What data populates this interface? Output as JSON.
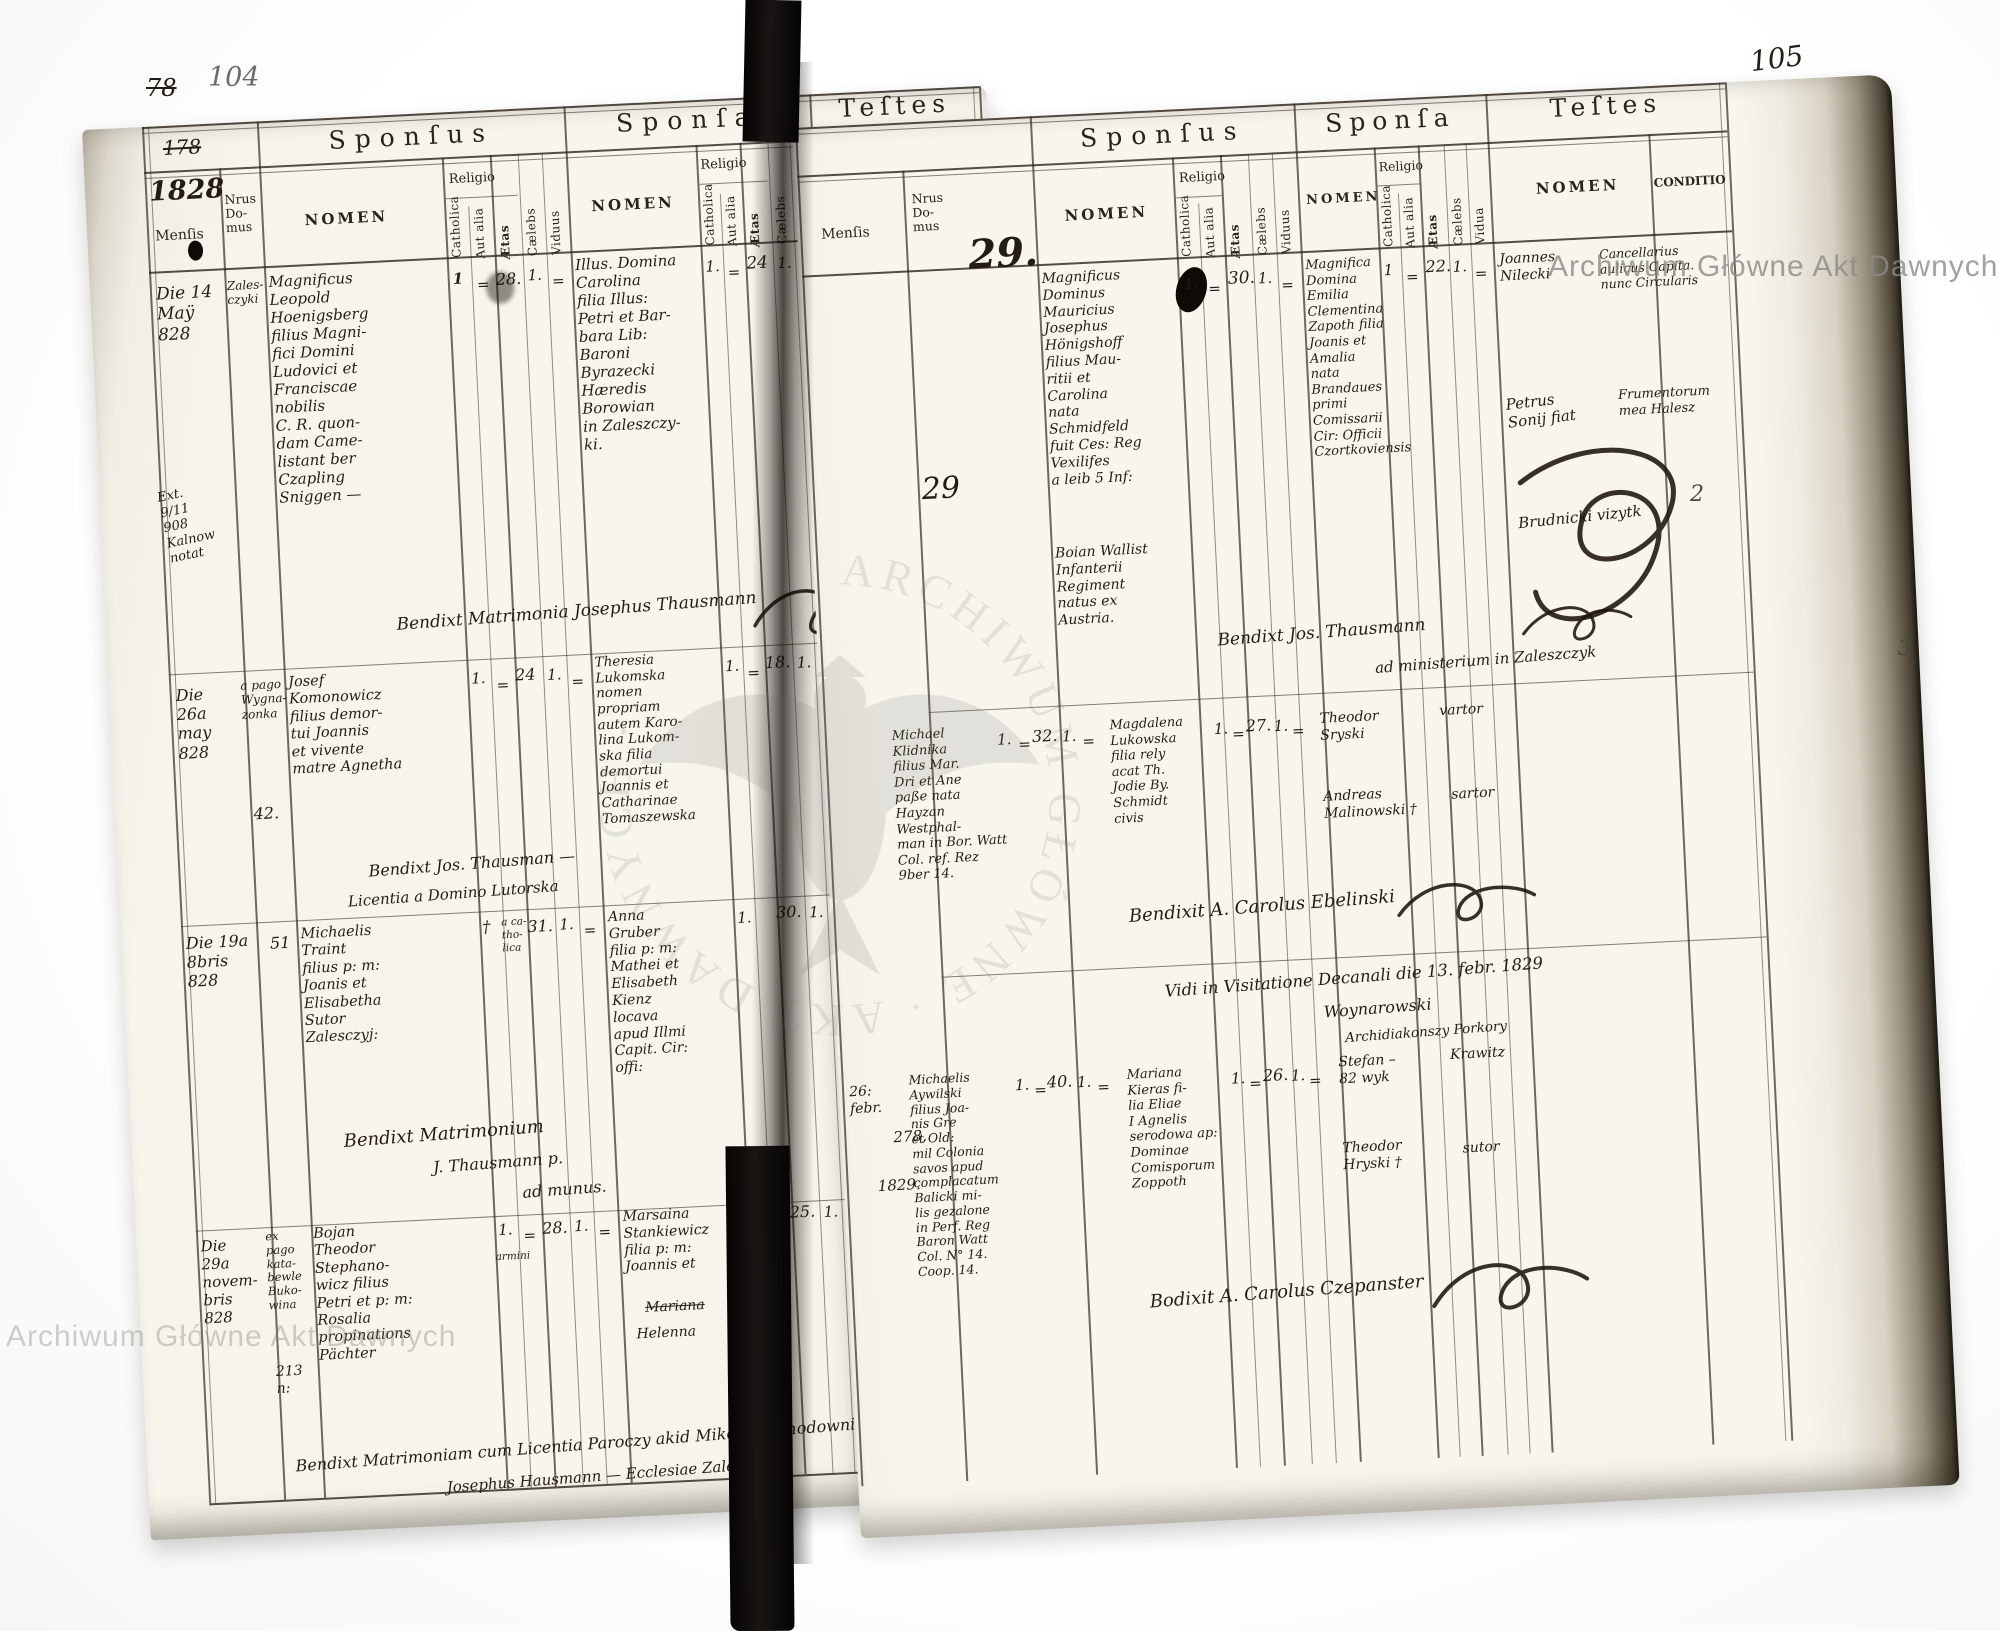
{
  "meta": {
    "left_folio_crossed": "78",
    "left_folio": "104",
    "right_folio": "105",
    "crossed_number": "178",
    "year": "1828",
    "margin_mark_2": "2",
    "margin_mark_3": "3"
  },
  "labels": {
    "sponsus": "Sponſus",
    "sponsa": "Sponſa",
    "testes": "Teſtes",
    "mensis": "Menſis",
    "nrus_domus": "Nrus\nDo-\nmus",
    "nomen": "NOMEN",
    "conditio": "CONDITIO",
    "religio": "Religio",
    "catholica": "Catholica",
    "aut_alia": "Aut alia",
    "aetas": "Ætas",
    "caelebs": "Cælebs",
    "viduus": "Viduus",
    "vidua": "Vidua"
  },
  "watermark": {
    "text": "Archiwum Główne Akt Dawnych",
    "emblem_ring": "ARCHIWUM GŁÓWNE · AKT DAWNYCH ·"
  },
  "l": {
    "r1": {
      "mensis": "Die 14\nMaÿ\n828",
      "margin_note": "Ext.\n9/11\n908\nKalnow\nnotat",
      "domus": "Zales-\nczyki",
      "sp_nomen": "Magnificus\nLeopold\nHoenigsberg\nfilius Magni-\nfici Domini\nLudovici et\nFranciscae\nnobilis\nC. R. quon-\ndam Came-\nlistant ber\nCzapling\nSniggen —",
      "sp_c": "1",
      "sp_a": "=",
      "sp_ae": "28.",
      "sp_cl": "1.",
      "sp_v": "=",
      "sa_nomen": "Illus. Domina\nCarolina\nfilia Illus:\nPetri et Bar-\nbara Lib:\nBaroni\nByrazecki\nHæredis\nBorowian\nin Zaleszczy-\nki.",
      "sa_c": "1.",
      "sa_a": "=",
      "sa_ae": "24",
      "sa_cl": "1.",
      "sa_v": "=",
      "t1": "Joannes Nilecki",
      "t2": "Antoni Orłowski",
      "cond1": "Comiteonis Gu-\nnialis et Capita-\nneus Circularis\nficunti Czortko-\nviensis.",
      "cond2": "Hæres bonor.\nac Nobilis",
      "bene": "Bendixt Matrimonia Josephus Thausmann"
    },
    "r2": {
      "mensis": "Die\n26a\nmay\n828",
      "domus1": "a pago\nWygna-\nzonka",
      "domus2": "42.",
      "sp_nomen": "Josef\nKomonowicz\nfilius demor-\ntui Joannis\net vivente\nmatre Agnetha",
      "sp_c": "1.",
      "sp_a": "=",
      "sp_ae": "24",
      "sp_cl": "1.",
      "sp_v": "=",
      "sa_nomen": "Theresia\nLukomska\nnomen\npropriam\nautem Karo-\nlina Lukom-\nska filia\ndemortui\nJoannis et\nCatharinae\nTomaszewska",
      "sa_c": "1.",
      "sa_a": "=",
      "sa_ae": "18.",
      "sa_cl": "1.",
      "sa_v": "=",
      "t1": "Matheusz\nJuzefowicz †",
      "t2": "Stanisław\nLakomski",
      "cond1": "Nobelis",
      "cond2": "Mastelarz",
      "bene1": "Bendixt Jos. Thausman —",
      "bene2": "Licentia a Domino Lutorska"
    },
    "r3": {
      "mensis": "Die 19a\n8bris\n828",
      "domus": "51",
      "sp_nomen": "Michaelis\nTraint\nfilius p: m:\nJoanis et\nElisabetha\nSutor\nZalesczyj:",
      "sp_c": "†",
      "sp_rel": "a ca-\ntho-\nlica",
      "sp_ae": "31.",
      "sp_cl": "1.",
      "sp_v": "=",
      "sa_nomen": "Anna\nGruber\nfilia p: m:\nMathei et\nElisabeth\nKienz\nlocava\napud Illmi\nCapit. Cir:\noffi:",
      "sa_c": "1.",
      "sa_a": "=",
      "sa_ae": "30.",
      "sa_cl": "1.",
      "sa_v": "=",
      "t1": "Georgius\nKhirzew-\nski †",
      "t2": "Antonius\nRaucz",
      "t3": "Joanes\nKhyntzel",
      "cond1": "Sartor\nZalesz:",
      "cond2": "Laut.\ngwann",
      "cond3": "Civis\nZalesz:",
      "bene1": "Bendixt Matrimonium",
      "bene2": "J. Thausmann p.",
      "bene3": "ad munus."
    },
    "r4": {
      "mensis": "Die\n29a\nnovem-\nbris\n828",
      "domus1": "ex\npago\nkata-\nbewle\nBuko-\nwina",
      "domus2": "213\nn:",
      "sp_nomen": "Bojan\nTheodor\nStephano-\nwicz filius\nPetri et p: m:\nRosalia\npropinations\nPächter",
      "sp_c": "1.",
      "sp_a": "=",
      "sp_rel": "armini",
      "sp_ae": "28.",
      "sp_cl": "1.",
      "sp_v": "=",
      "sa_nomen": "Marsaina\nStankiewicz\nfilia p: m:\nJoannis et",
      "sa_struck": "Mariana",
      "sa_nomen2": "Helenna",
      "sa_c": "1.",
      "sa_a": "=",
      "sa_rel": "armini",
      "sa_ae": "25.",
      "sa_cl": "1.",
      "sa_v": "=",
      "t1": "Antoni\nLenkiewicz",
      "t2": "Teodor\nHatun",
      "t3": "Jakub\nLukiewicz",
      "cond1": "Preczmistrz",
      "cond2": "Jurgher",
      "cond3": "Mechtik\nGutthaber",
      "cond4": "D. r. A:\nin Snestyn",
      "bene1": "Bendixt Matrimoniam cum Licentia Paroczy akid Mikolai Zlahodowni",
      "bene2": "Josephus Hausmann — Ecclesiae Zalesz. n. k."
    }
  },
  "r": {
    "mark29a": "29.",
    "mark29b": "29",
    "r1": {
      "sp_nomen": "Magnificus\nDominus\nMauricius\nJosephus\nHönigshoff\nfilius Mau-\nritii et\nCarolina\nnata\nSchmidfeld\nfuit Ces: Reg\nVexilifes\na leib 5 Inf:",
      "sp_nomen2": "Boian Wallist\nInfanterii\nRegiment\nnatus ex\nAustria.",
      "sp_c": "1.",
      "sp_a": "=",
      "sp_ae": "30.",
      "sp_cl": "1.",
      "sp_v": "=",
      "sa_nomen": "Magnifica\nDomina\nEmilia\nClementina\nZapoth filia\nJoanis et\nAmalia\nnata\nBrandaues\nprimi\nComissarii\nCir: Officii\nCzortkoviensis",
      "sa_c": "1",
      "sa_a": "=",
      "sa_ae": "22.",
      "sa_cl": "1.",
      "sa_v": "=",
      "t1": "Joannes\nNilecki",
      "t2": "Petrus\nSonij fiat",
      "t3": "Brudnicki vizytk",
      "cond1": "Cancellarius\naulicus Capita.\nnunc Circularis",
      "cond2": "Frumentorum\nmea Halesz",
      "bene1": "Bendixt Jos. Thausmann",
      "bene2": "ad ministerium in Zaleszczyk"
    },
    "r2": {
      "sp_nomen": "Michael\nKlidnika\nfilius Mar.\nDri et Ane\npaße nata\nHayzan\nWestphal-\nman in Bor. Watt\nCol. ref. Rez\n9ber 14.",
      "sp_c": "1.",
      "sp_a": "=",
      "sp_ae": "32.",
      "sp_cl": "1.",
      "sp_v": "=",
      "sa_nomen": "Magdalena\nLukowska\nfilia rely\nacat Th.\nJodie By.\nSchmidt\ncivis",
      "sa_c": "1.",
      "sa_a": "=",
      "sa_ae": "27.",
      "sa_cl": "1.",
      "sa_v": "=",
      "t1": "Theodor\nSryski",
      "t2": "Andreas\nMalinowski †",
      "cond1": "vartor",
      "cond2": "sartor",
      "bene": "Bendixit A. Carolus Ebelinski"
    },
    "visit": {
      "line": "Vidi in Visitatione Decanali die 13. febr. 1829",
      "sig1": "Woynarowski",
      "sig2": "Archidiakonszy Porkory"
    },
    "r3": {
      "mensis": "26:\nfebr.",
      "domus": "278,",
      "year": "1829.",
      "sp_nomen": "Michaelis\nAywilski\nfilius Joa-\nnis Gre\net Old:\nmil Colonia\nsavos apud\ncomplacatum\nBalicki mi-\nlis gezalone\nin Perf. Reg\nBaron Watt\nCol. N° 14.\nCoop. 14.",
      "sp_c": "1.",
      "sp_a": "=",
      "sp_ae": "40.",
      "sp_cl": "1.",
      "sp_v": "=",
      "sa_nomen": "Mariana\nKieras fi-\nlia Eliae\nI Agnelis\nserodowa ap:\nDominae\nComisporum\nZoppoth",
      "sa_c": "1.",
      "sa_a": "=",
      "sa_ae": "26.",
      "sa_cl": "1.",
      "sa_v": "=",
      "t1": "Stefan –\n82 wyk",
      "t2": "Theodor\nHryski †",
      "cond1": "Krawitz",
      "cond2": "sutor",
      "bene": "Bodixit A. Carolus Czepanster"
    }
  }
}
